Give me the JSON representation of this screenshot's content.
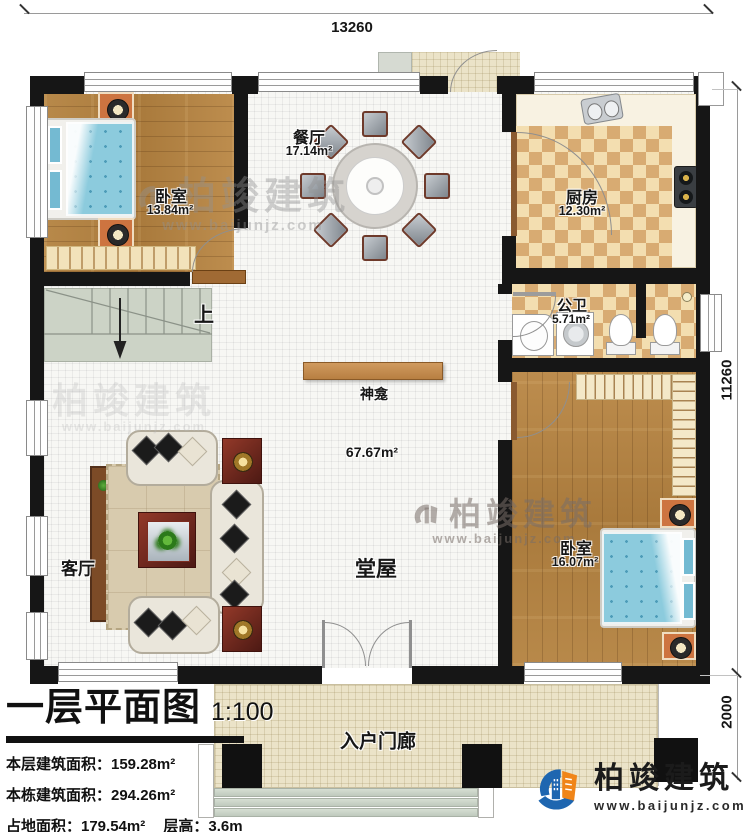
{
  "plan": {
    "dimensions": {
      "width_top": "13260",
      "height_right": "11260",
      "porch_depth": "2000"
    },
    "rooms": {
      "bedroom1": {
        "name": "卧室",
        "area": "13.84m²"
      },
      "dining": {
        "name": "餐厅",
        "area": "17.14m²"
      },
      "kitchen": {
        "name": "厨房",
        "area": "12.30m²"
      },
      "bathroom": {
        "name": "公卫",
        "area": "5.71m²"
      },
      "bedroom2": {
        "name": "卧室",
        "area": "16.07m²"
      },
      "hall": {
        "name": "堂屋",
        "area": "67.67m²"
      },
      "living": {
        "name": "客厅"
      },
      "shrine": {
        "name": "神龛"
      },
      "porch": {
        "name": "入户门廊"
      },
      "stairs_up": {
        "label": "上"
      }
    }
  },
  "title_block": {
    "title": "一层平面图",
    "scale": "1:100",
    "floor_area_label": "本层建筑面积：159.28m²",
    "building_area_label": "本栋建筑面积：294.26m²",
    "land_area_label": "占地面积：179.54m²",
    "floor_height_label": "层高：3.6m"
  },
  "branding": {
    "company": "柏竣建筑",
    "website": "www.baijunjz.com"
  },
  "watermarks": {
    "company": "柏竣建筑",
    "website": "www.baijunjz.com"
  },
  "colors": {
    "wall": "#161616",
    "wood": "#b3823f",
    "checker_dark": "#d8ab72",
    "checker_light": "#f3deb0",
    "tile": "#f7f7f4",
    "porch_tile": "#ebe3c8",
    "stairs": "#ccd3c6",
    "bed_blue": "#8ccbdd",
    "accent_red": "#6e241c",
    "cabinet_orange": "#cd7440",
    "logo_blue": "#1e66b0",
    "logo_orange": "#f08519"
  }
}
